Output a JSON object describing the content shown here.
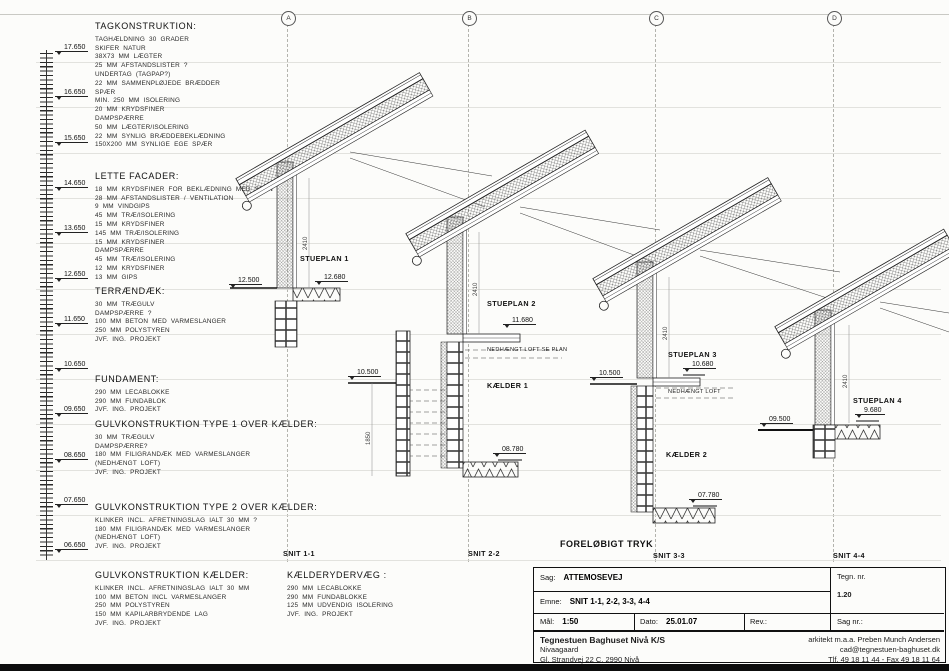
{
  "sheet": {
    "grid_bubbles": [
      "A",
      "B",
      "C",
      "D"
    ],
    "stamp": "FORELØBIGT TRYK"
  },
  "ruler": {
    "elevations": [
      "17.650",
      "16.650",
      "15.650",
      "14.650",
      "13.650",
      "12.650",
      "11.650",
      "10.650",
      "09.650",
      "08.650",
      "07.650",
      "06.650"
    ]
  },
  "notes": [
    {
      "title": "TAGKONSTRUKTION:",
      "lines": [
        "TAGHÆLDNING 30 GRADER",
        "SKIFER NATUR",
        "38X73 MM LÆGTER",
        "25 MM AFSTANDSLISTER ?",
        "UNDERTAG (TAGPAP?)",
        "22 MM SAMMENPLØJEDE BRÆDDER",
        "SPÆR",
        "MIN. 250 MM ISOLERING",
        "20 MM KRYDSFINER",
        "DAMPSPÆRRE",
        "50 MM LÆGTER/ISOLERING",
        "22 MM SYNLIG BRÆDDEBEKLÆDNING",
        "150X200 MM SYNLIGE EGE SPÆR"
      ]
    },
    {
      "title": "LETTE FACADER:",
      "lines": [
        "18 MM KRYDSFINER FOR BEKLÆDNING MED SPÅN",
        "28 MM AFSTANDSLISTER / VENTILATION",
        "9 MM VINDGIPS",
        "45 MM TRÆ/ISOLERING",
        "15 MM KRYDSFINER",
        "145 MM TRÆ/ISOLERING",
        "15 MM KRYDSFINER",
        "DAMPSPÆRRE",
        "45 MM TRÆ/ISOLERING",
        "12 MM KRYDSFINER",
        "13 MM GIPS"
      ]
    },
    {
      "title": "TERRÆNDÆK:",
      "lines": [
        "30 MM TRÆGULV",
        "DAMPSPÆRRE ?",
        "100 MM BETON MED VARMESLANGER",
        "250 MM POLYSTYREN",
        "JVF. ING. PROJEKT"
      ]
    },
    {
      "title": "FUNDAMENT:",
      "lines": [
        "290 MM LECABLOKKE",
        "290 MM FUNDABLOK",
        "JVF. ING. PROJEKT"
      ]
    },
    {
      "title": "GULVKONSTRUKTION TYPE 1 OVER KÆLDER:",
      "lines": [
        "30 MM TRÆGULV",
        "DAMPSPÆRRE?",
        "180 MM FILIGRANDÆK MED VARMESLANGER",
        "(NEDHÆNGT LOFT)",
        "JVF. ING. PROJEKT"
      ]
    },
    {
      "title": "GULVKONSTRUKTION TYPE 2 OVER KÆLDER:",
      "lines": [
        "KLINKER INCL. AFRETNINGSLAG IALT 30 MM ?",
        "180 MM FILIGRANDÆK MED VARMESLANGER",
        "(NEDHÆNGT LOFT)",
        "JVF. ING. PROJEKT"
      ]
    },
    {
      "title": "GULVKONSTRUKTION KÆLDER:",
      "lines": [
        "KLINKER INCL. AFRETNINGSLAG IALT 30 MM",
        "100 MM BETON INCL VARMESLANGER",
        "250 MM POLYSTYREN",
        "150 MM KAPILARBRYDENDE LAG",
        "JVF. ING. PROJEKT"
      ]
    },
    {
      "title": "KÆLDERYDERVÆG :",
      "lines": [
        "290 MM LECABLOKKE",
        "290 MM FUNDABLOKKE",
        "125 MM UDVENDIG ISOLERING",
        "JVF. ING. PROJEKT"
      ]
    }
  ],
  "sections": [
    {
      "snit": "SNIT 1-1",
      "plan": "STUEPLAN 1",
      "floor_level": "12.500",
      "deck_level": "12.680",
      "wall_dim": "2410"
    },
    {
      "snit": "SNIT 2-2",
      "plan": "STUEPLAN 2",
      "deck_level": "11.680",
      "ceiling_note": "NEDHÆNGT LOFT SE PLAN",
      "terrain_level": "10.500",
      "basement": "KÆLDER 1",
      "basement_floor_level": "08.780",
      "wall_dim": "2410",
      "basement_dim": "1850"
    },
    {
      "snit": "SNIT 3-3",
      "plan": "STUEPLAN 3",
      "deck_level": "10.680",
      "ceiling_note": "NEDHÆNGT LOFT",
      "terrain_level": "10.500",
      "basement": "KÆLDER 2",
      "basement_floor_level": "07.780",
      "wall_dim": "2410"
    },
    {
      "snit": "SNIT 4-4",
      "plan": "STUEPLAN 4",
      "deck_level": "9.680",
      "terrain_level": "09.500",
      "wall_dim": "2410"
    }
  ],
  "titleblock": {
    "sag_label": "Sag:",
    "sag": "ATTEMOSEVEJ",
    "tegn_label": "Tegn. nr.",
    "tegn": "1.20",
    "emne_label": "Emne:",
    "emne": "SNIT 1-1, 2-2, 3-3, 4-4",
    "maal_label": "Mål:",
    "maal": "1:50",
    "dato_label": "Dato:",
    "dato": "25.01.07",
    "rev_label": "Rev.:",
    "sagnr_label": "Sag nr.:",
    "firm": "Tegnestuen Baghuset Nivå K/S",
    "firm_line2": "Nivaagaard",
    "firm_line3": "Gl. Strandvej 22 C, 2990 Nivå",
    "architect": "arkitekt m.a.a. Preben Munch Andersen",
    "email": "cad@tegnestuen-baghuset.dk",
    "phone": "Tlf. 49 18 11 44 - Fax 49 18 11 64"
  }
}
